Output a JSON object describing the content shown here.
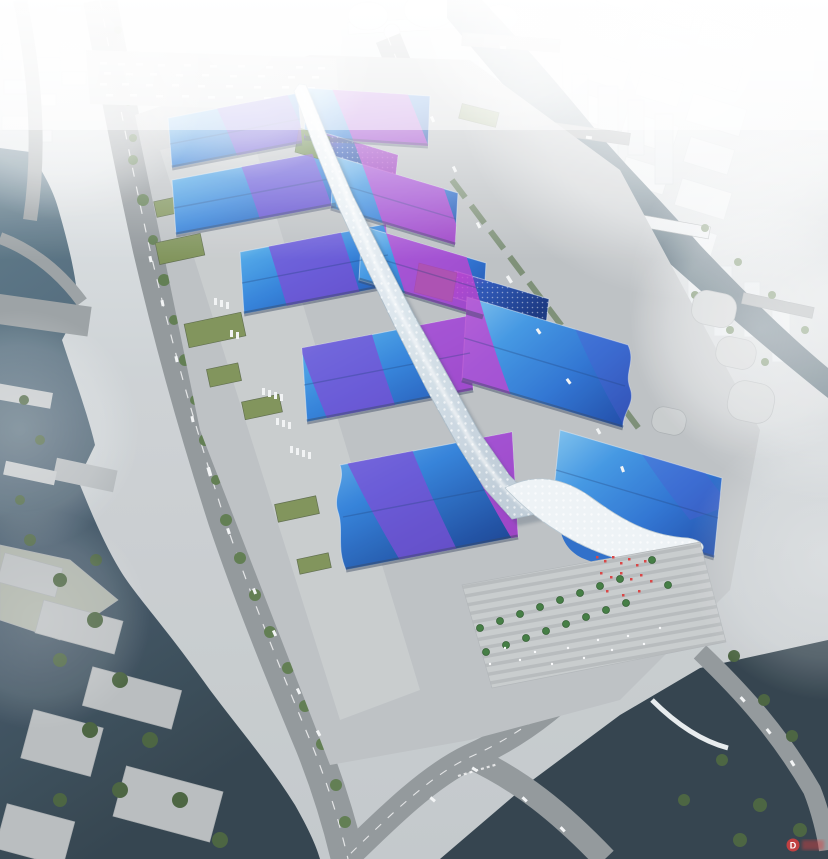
{
  "scene": {
    "description": "Aerial perspective rendering of a large exhibition and convention center complex with wave-patterned blue roofs, a white serpentine central canopy spine, surrounded by rivers, boulevards and a hazy city skyline",
    "watermark": {
      "logo_letter": "D"
    }
  },
  "palette": {
    "platform_grey": "#bcc0c3",
    "apron_light": "#c9cdcf",
    "plaza_grey": "#c7cbcd",
    "road_grey": "#90969a",
    "bridge_grey": "#9aa0a3",
    "facade_dark": "#32435a",
    "tree_green": "#5d7a4e",
    "tree_dark": "#46603c",
    "lawn_green": "#7d9157",
    "greenroof": "#5e7f3f",
    "roof_blue_light": "#7fc6ef",
    "roof_blue": "#2f7fd9",
    "roof_blue_deep": "#1d4fae",
    "ribbon_magenta": "#c03ecf",
    "ribbon_purple": "#7a46d6",
    "ribbon_violet": "#4a55d0",
    "spine_white": "#e9f0f4",
    "shell_white": "#eef3f6",
    "water_pond": "#2e3e49",
    "city_white": "#eceff1",
    "car_white": "#f2f4f5",
    "red_accent": "#d84040"
  }
}
